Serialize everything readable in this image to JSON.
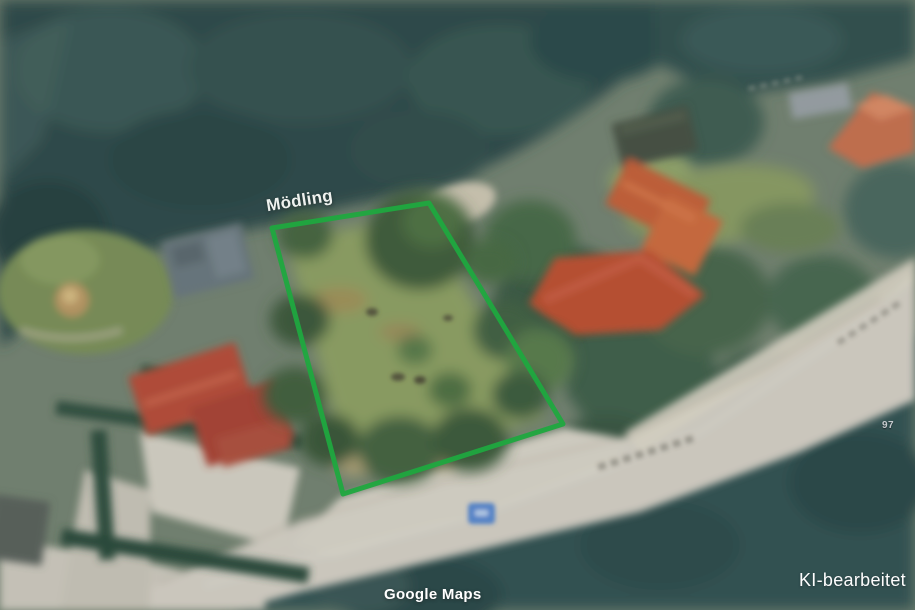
{
  "labels": {
    "place": "Mödling",
    "attribution": "Google Maps",
    "watermark": "KI-bearbeitet",
    "house_number": "97"
  },
  "boundary": {
    "color": "#1fa83f",
    "points": "272,228 429,203 563,424 343,494"
  },
  "road_shield": {
    "color": "#4b80ce"
  }
}
